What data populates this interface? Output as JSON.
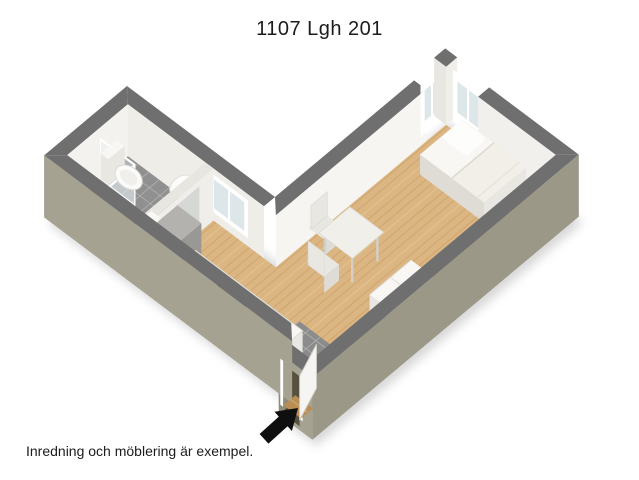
{
  "title": "1107 Lgh 201",
  "caption": "Inredning och möblering är exempel.",
  "palette": {
    "bg": "#ffffff",
    "cap": "#6f6f6f",
    "ext": "#a5a291",
    "extDark": "#9b9887",
    "extDarker": "#8f8c7b",
    "intBright": "#f6f5f1",
    "int1": "#f4f2ee",
    "int2": "#f1efe9",
    "int3": "#efede8",
    "int4": "#f2f0ec",
    "wood": "#dcb682",
    "woodStripe": "#c3945c",
    "woodLight": "#edd3a1",
    "tile": "#909090",
    "tileEntr": "#8b8b8b",
    "grout": "#b8b8b8",
    "white1": "#f8f7f4",
    "white2": "#e9e7e2",
    "white3": "#dfdcd6",
    "applTop": "#b3b2af",
    "applSide": "#999894",
    "stove": "#2e2e2e",
    "ring": "#4a4a4a",
    "steel": "#cfcecb",
    "steelDark": "#a8a7a3",
    "radTop": "#a07c4c",
    "radX": "#8a683c",
    "radY": "#7d5e36",
    "radLine": "#6e5230",
    "door": "#f6f5f2",
    "doorEdge": "#cfccc6",
    "glass": "#dde6e9",
    "frame": "#ffffff",
    "divCap": "#e8e6e1",
    "divFace": "#f0eeea",
    "glimpse": "#d6d8d6",
    "opening": "#57523f",
    "threshold": "#b98e55",
    "shadow": "#b0b0b0",
    "arrow": "#0f0f0f",
    "text": "#1c1c1c"
  },
  "depicted": {
    "rooms": [
      "bathroom",
      "kitchen",
      "hallway",
      "living-sleeping-room",
      "entrance-hall"
    ],
    "objects": [
      "toilet",
      "washbasin",
      "shower-corner",
      "bathroom-door",
      "refrigerator",
      "kitchen-cabinet",
      "kitchen-counter",
      "stove",
      "kitchen-sink",
      "dining-table",
      "chairs",
      "single-bed",
      "pillow",
      "desk",
      "radiator",
      "front-door",
      "kitchen-window",
      "corner-windows",
      "entrance-arrow"
    ]
  }
}
